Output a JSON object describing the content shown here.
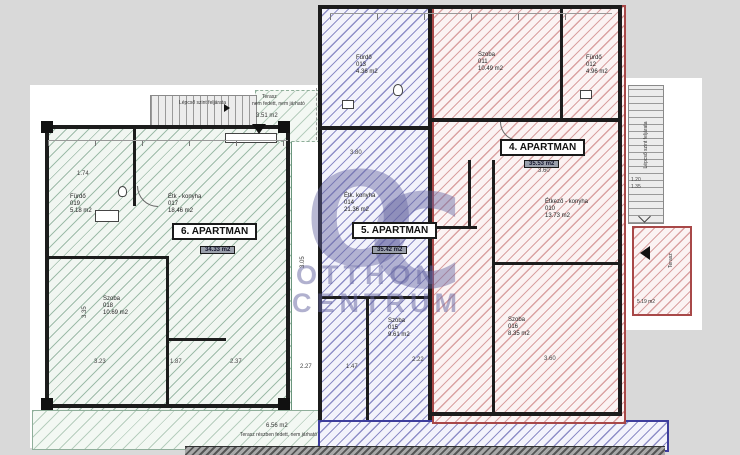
{
  "watermark": {
    "logo_left": "O",
    "logo_right": "C",
    "line1": "OTTHON",
    "line2": "CENTRUM"
  },
  "apartments": [
    {
      "label": "4. APARTMAN",
      "area_box": "35.53 m2",
      "rooms": [
        {
          "name": "Szoba",
          "num": "011",
          "area": "10.49 m2"
        },
        {
          "name": "Fürdő",
          "num": "012",
          "area": "4.96 m2"
        },
        {
          "name": "Étkező - konyha",
          "num": "010",
          "area": "13.73 m2"
        },
        {
          "name": "Szoba",
          "num": "016",
          "area": "8.35 m2"
        }
      ]
    },
    {
      "label": "5. APARTMAN",
      "area_box": "35.42 m2",
      "rooms": [
        {
          "name": "Fürdő",
          "num": "013",
          "area": "4.36 m2"
        },
        {
          "name": "Étk. konyha",
          "num": "014",
          "area": "21.36 m2"
        },
        {
          "name": "Szoba",
          "num": "015",
          "area": "9.61 m2"
        }
      ]
    },
    {
      "label": "6. APARTMAN",
      "area_box": "34.33 m2",
      "rooms": [
        {
          "name": "Fürdő",
          "num": "019",
          "area": "5.18 m2"
        },
        {
          "name": "Étk - konyha",
          "num": "017",
          "area": "18.46 m2"
        },
        {
          "name": "Szoba",
          "num": "018",
          "area": "10.69 m2"
        }
      ]
    }
  ],
  "annotations": {
    "stair_top": "Lépcső szint feljárata",
    "stair_right": "Lépcső szint feljárata",
    "terasz_top_name": "Terasz",
    "terasz_top_note": "nem fedett, nem járható",
    "terasz_top_area": "3.51 m2",
    "terasz_right_name": "Terasz",
    "terasz_right_area": "5.19 m2",
    "terasz_bottom_area": "6.56 m2",
    "terasz_bottom_note": "Terasz részben fedett, nem járható"
  },
  "dims": [
    "1.74",
    "3.35",
    "3.23",
    "1.87",
    "2.37",
    "2.27",
    "1.47",
    "2.22",
    "3.80",
    "3.60",
    "3.60",
    "3.05",
    "1.20",
    "1.35"
  ]
}
